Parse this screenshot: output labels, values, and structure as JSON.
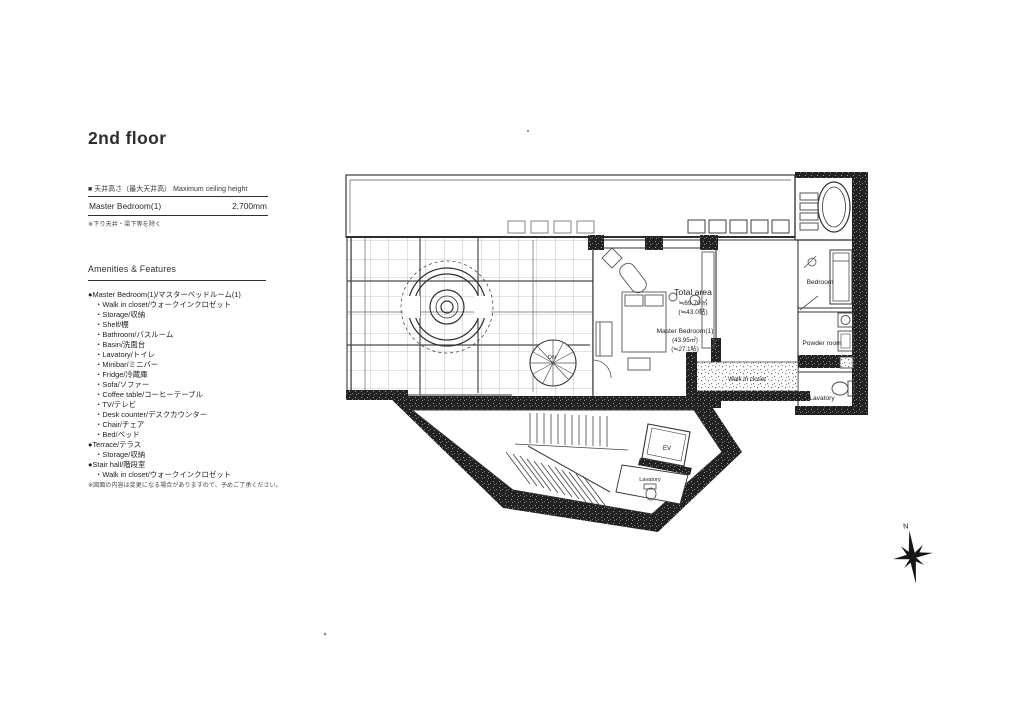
{
  "page": {
    "title": "2nd floor"
  },
  "ceiling_table": {
    "header": "■ 天井高さ（最大天井高） Maximum ceiling height",
    "row": {
      "label": "Master Bedroom(1)",
      "value": "2,700mm"
    },
    "footnote": "※下り天井・梁下等を除く"
  },
  "amenities": {
    "heading": "Amenities & Features",
    "groups": [
      {
        "title": "●Master Bedroom(1)/マスターベッドルーム(1)",
        "items": [
          "・Walk in closet/ウォークインクロゼット",
          "・Storage/収納",
          "・Shelf/棚",
          "・Bathroom/バスルーム",
          "・Basin/洗面台",
          "・Lavatory/トイレ",
          "・Minibar/ミニバー",
          "・Fridge/冷蔵庫",
          "・Sofa/ソファー",
          "・Coffee table/コーヒーテーブル",
          "・TV/テレビ",
          "・Desk counter/デスクカウンター",
          "・Chair/チェア",
          "・Bed/ベッド"
        ]
      },
      {
        "title": "●Terrace/テラス",
        "items": [
          "・Storage/収納"
        ]
      },
      {
        "title": "●Stair hall/階段室",
        "items": [
          "・Walk in closet/ウォークインクロゼット"
        ]
      }
    ],
    "footnote": "※図面の内容は変更になる場合がありますので、予めご了承ください。"
  },
  "floorplan": {
    "total_area": {
      "title": "Total area",
      "sqm": "≒69.70㎡",
      "jo": "(≒43.0帖)"
    },
    "master_bedroom_area": {
      "title": "Master Bedroom(1)",
      "sqm": "(43.95㎡)",
      "jo": "(≒27.1帖)"
    },
    "labels": {
      "bedroom": "Bedroom",
      "powder_room": "Powder room",
      "lavatory_right": "Lavatory",
      "walk_in_closet": "Walk in closet",
      "elevator": "EV",
      "lavatory_stairhall": "Lavatory",
      "stair_down": "DN"
    },
    "compass": {
      "north": "N"
    },
    "ink_color": "#2e2e2e"
  }
}
